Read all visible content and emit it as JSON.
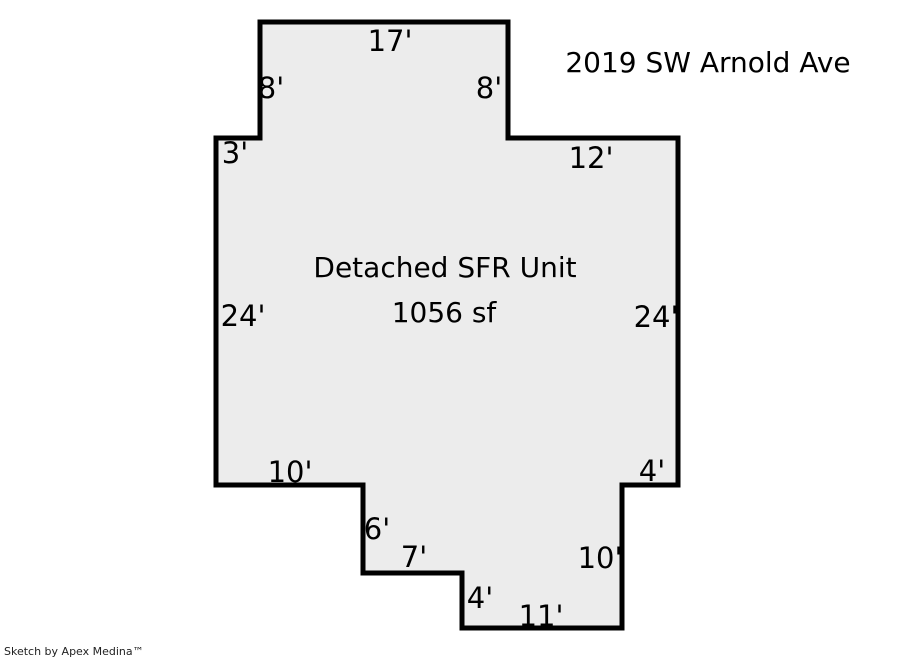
{
  "page": {
    "address": "2019 SW Arnold Ave",
    "footer": "Sketch by Apex Medina™"
  },
  "building": {
    "label": "Detached SFR Unit",
    "area": "1056 sf"
  },
  "dimensions": [
    {
      "edge": "top",
      "text": "17'"
    },
    {
      "edge": "upper-right",
      "text": "8'"
    },
    {
      "edge": "right-step-top",
      "text": "12'"
    },
    {
      "edge": "right",
      "text": "24'"
    },
    {
      "edge": "right-notch-top",
      "text": "4'"
    },
    {
      "edge": "lower-right",
      "text": "10'"
    },
    {
      "edge": "bottom",
      "text": "11'"
    },
    {
      "edge": "bottom-notch-left",
      "text": "4'"
    },
    {
      "edge": "bottom-step",
      "text": "7'"
    },
    {
      "edge": "bottom-step-left",
      "text": "6'"
    },
    {
      "edge": "lower-left",
      "text": "10'"
    },
    {
      "edge": "left",
      "text": "24'"
    },
    {
      "edge": "left-step-top",
      "text": "3'"
    },
    {
      "edge": "upper-left",
      "text": "8'"
    }
  ],
  "colors": {
    "background": "#ffffff",
    "building_fill": "#ececec",
    "building_outline": "#000000",
    "text": "#000000"
  }
}
